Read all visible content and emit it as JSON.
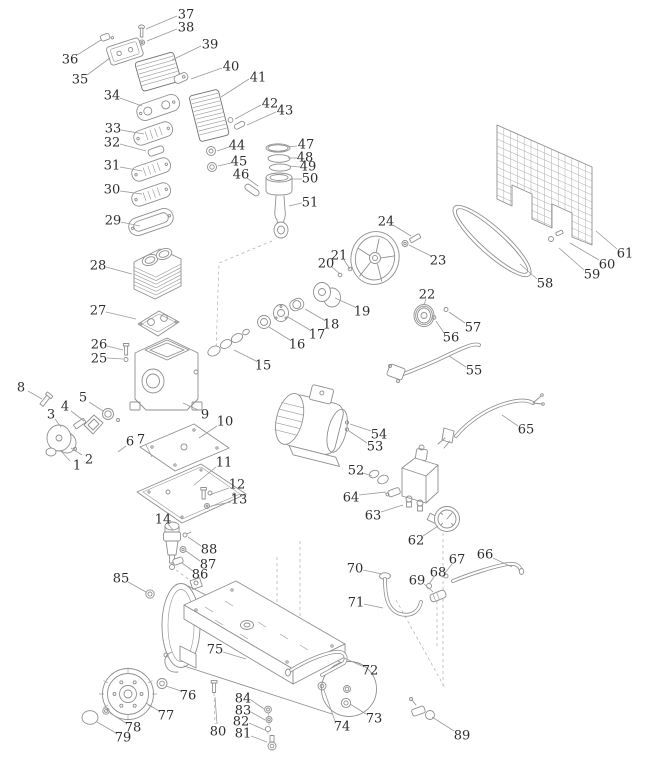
{
  "diagram": {
    "kind": "exploded-parts-diagram",
    "colors": {
      "background": "#ffffff",
      "line": "#8f8f8f",
      "line_dark": "#707070",
      "grid": "#b3b3b3",
      "label": "#2d2d2d",
      "leader": "#9a9a9a"
    },
    "callouts": [
      {
        "n": "1",
        "x": 77,
        "y": 465,
        "x1": 70,
        "y1": 461,
        "x2": 60,
        "y2": 450
      },
      {
        "n": "2",
        "x": 89,
        "y": 459,
        "x1": 82,
        "y1": 455,
        "x2": 71,
        "y2": 448
      },
      {
        "n": "3",
        "x": 51,
        "y": 414,
        "x1": 55,
        "y1": 419,
        "x2": 61,
        "y2": 427
      },
      {
        "n": "4",
        "x": 65,
        "y": 406,
        "x1": 71,
        "y1": 411,
        "x2": 84,
        "y2": 421
      },
      {
        "n": "5",
        "x": 83,
        "y": 397,
        "x1": 89,
        "y1": 402,
        "x2": 103,
        "y2": 411
      },
      {
        "n": "6",
        "x": 130,
        "y": 441,
        "x1": 126,
        "y1": 446,
        "x2": 118,
        "y2": 452
      },
      {
        "n": "7",
        "x": 141,
        "y": 439,
        "x1": 146,
        "y1": 445,
        "x2": 152,
        "y2": 457
      },
      {
        "n": "8",
        "x": 21,
        "y": 387,
        "x1": 28,
        "y1": 391,
        "x2": 42,
        "y2": 399
      },
      {
        "n": "9",
        "x": 205,
        "y": 414,
        "x1": 198,
        "y1": 410,
        "x2": 183,
        "y2": 403
      },
      {
        "n": "10",
        "x": 225,
        "y": 421,
        "x1": 217,
        "y1": 426,
        "x2": 199,
        "y2": 438
      },
      {
        "n": "11",
        "x": 224,
        "y": 462,
        "x1": 216,
        "y1": 467,
        "x2": 194,
        "y2": 485
      },
      {
        "n": "12",
        "x": 237,
        "y": 484,
        "x1": 229,
        "y1": 488,
        "x2": 209,
        "y2": 495
      },
      {
        "n": "13",
        "x": 239,
        "y": 499,
        "x1": 231,
        "y1": 502,
        "x2": 211,
        "y2": 506
      },
      {
        "n": "14",
        "x": 163,
        "y": 519,
        "x1": 168,
        "y1": 524,
        "x2": 173,
        "y2": 530
      },
      {
        "n": "15",
        "x": 263,
        "y": 365,
        "x1": 256,
        "y1": 361,
        "x2": 234,
        "y2": 350
      },
      {
        "n": "16",
        "x": 297,
        "y": 344,
        "x1": 290,
        "y1": 340,
        "x2": 269,
        "y2": 327
      },
      {
        "n": "17",
        "x": 317,
        "y": 334,
        "x1": 310,
        "y1": 330,
        "x2": 288,
        "y2": 317
      },
      {
        "n": "18",
        "x": 331,
        "y": 324,
        "x1": 324,
        "y1": 320,
        "x2": 305,
        "y2": 309
      },
      {
        "n": "19",
        "x": 362,
        "y": 311,
        "x1": 355,
        "y1": 307,
        "x2": 335,
        "y2": 298
      },
      {
        "n": "20",
        "x": 326,
        "y": 263,
        "x1": 332,
        "y1": 267,
        "x2": 340,
        "y2": 274
      },
      {
        "n": "21",
        "x": 339,
        "y": 255,
        "x1": 344,
        "y1": 260,
        "x2": 350,
        "y2": 269
      },
      {
        "n": "22",
        "x": 427,
        "y": 294,
        "x1": 426,
        "y1": 299,
        "x2": 424,
        "y2": 305
      },
      {
        "n": "23",
        "x": 438,
        "y": 260,
        "x1": 431,
        "y1": 256,
        "x2": 409,
        "y2": 245
      },
      {
        "n": "24",
        "x": 386,
        "y": 221,
        "x1": 393,
        "y1": 225,
        "x2": 411,
        "y2": 236
      },
      {
        "n": "25",
        "x": 99,
        "y": 358,
        "x1": 107,
        "y1": 358,
        "x2": 123,
        "y2": 359
      },
      {
        "n": "26",
        "x": 99,
        "y": 344,
        "x1": 107,
        "y1": 346,
        "x2": 123,
        "y2": 350
      },
      {
        "n": "27",
        "x": 98,
        "y": 310,
        "x1": 106,
        "y1": 312,
        "x2": 136,
        "y2": 319
      },
      {
        "n": "28",
        "x": 98,
        "y": 265,
        "x1": 106,
        "y1": 267,
        "x2": 132,
        "y2": 274
      },
      {
        "n": "29",
        "x": 113,
        "y": 220,
        "x1": 121,
        "y1": 222,
        "x2": 140,
        "y2": 226
      },
      {
        "n": "30",
        "x": 112,
        "y": 189,
        "x1": 120,
        "y1": 191,
        "x2": 142,
        "y2": 194
      },
      {
        "n": "31",
        "x": 112,
        "y": 165,
        "x1": 120,
        "y1": 167,
        "x2": 142,
        "y2": 171
      },
      {
        "n": "32",
        "x": 112,
        "y": 142,
        "x1": 120,
        "y1": 144,
        "x2": 146,
        "y2": 151
      },
      {
        "n": "33",
        "x": 113,
        "y": 128,
        "x1": 121,
        "y1": 130,
        "x2": 144,
        "y2": 134
      },
      {
        "n": "34",
        "x": 112,
        "y": 95,
        "x1": 120,
        "y1": 98,
        "x2": 142,
        "y2": 106
      },
      {
        "n": "35",
        "x": 80,
        "y": 79,
        "x1": 87,
        "y1": 75,
        "x2": 110,
        "y2": 58
      },
      {
        "n": "36",
        "x": 70,
        "y": 59,
        "x1": 77,
        "y1": 55,
        "x2": 101,
        "y2": 40
      },
      {
        "n": "37",
        "x": 186,
        "y": 14,
        "x1": 177,
        "y1": 16,
        "x2": 146,
        "y2": 29
      },
      {
        "n": "38",
        "x": 186,
        "y": 27,
        "x1": 177,
        "y1": 29,
        "x2": 147,
        "y2": 41
      },
      {
        "n": "39",
        "x": 210,
        "y": 44,
        "x1": 201,
        "y1": 46,
        "x2": 172,
        "y2": 60
      },
      {
        "n": "40",
        "x": 231,
        "y": 66,
        "x1": 222,
        "y1": 68,
        "x2": 191,
        "y2": 79
      },
      {
        "n": "41",
        "x": 258,
        "y": 77,
        "x1": 249,
        "y1": 79,
        "x2": 221,
        "y2": 97
      },
      {
        "n": "42",
        "x": 270,
        "y": 103,
        "x1": 261,
        "y1": 105,
        "x2": 235,
        "y2": 119
      },
      {
        "n": "43",
        "x": 285,
        "y": 110,
        "x1": 276,
        "y1": 112,
        "x2": 247,
        "y2": 125
      },
      {
        "n": "44",
        "x": 237,
        "y": 145,
        "x1": 229,
        "y1": 147,
        "x2": 217,
        "y2": 151
      },
      {
        "n": "45",
        "x": 239,
        "y": 161,
        "x1": 231,
        "y1": 163,
        "x2": 218,
        "y2": 166
      },
      {
        "n": "46",
        "x": 241,
        "y": 174,
        "x1": 247,
        "y1": 178,
        "x2": 258,
        "y2": 186
      },
      {
        "n": "47",
        "x": 306,
        "y": 144,
        "x1": 297,
        "y1": 146,
        "x2": 287,
        "y2": 147
      },
      {
        "n": "48",
        "x": 305,
        "y": 157,
        "x1": 297,
        "y1": 158,
        "x2": 288,
        "y2": 158
      },
      {
        "n": "49",
        "x": 308,
        "y": 166,
        "x1": 300,
        "y1": 167,
        "x2": 289,
        "y2": 166
      },
      {
        "n": "50",
        "x": 310,
        "y": 178,
        "x1": 302,
        "y1": 179,
        "x2": 290,
        "y2": 179
      },
      {
        "n": "51",
        "x": 310,
        "y": 202,
        "x1": 302,
        "y1": 203,
        "x2": 289,
        "y2": 206
      },
      {
        "n": "52",
        "x": 356,
        "y": 470,
        "x1": 363,
        "y1": 473,
        "x2": 372,
        "y2": 476
      },
      {
        "n": "53",
        "x": 375,
        "y": 446,
        "x1": 367,
        "y1": 443,
        "x2": 349,
        "y2": 431
      },
      {
        "n": "54",
        "x": 379,
        "y": 434,
        "x1": 371,
        "y1": 431,
        "x2": 350,
        "y2": 424
      },
      {
        "n": "55",
        "x": 474,
        "y": 370,
        "x1": 466,
        "y1": 367,
        "x2": 449,
        "y2": 356
      },
      {
        "n": "56",
        "x": 451,
        "y": 337,
        "x1": 444,
        "y1": 333,
        "x2": 436,
        "y2": 321
      },
      {
        "n": "57",
        "x": 473,
        "y": 327,
        "x1": 465,
        "y1": 323,
        "x2": 449,
        "y2": 312
      },
      {
        "n": "58",
        "x": 545,
        "y": 283,
        "x1": 537,
        "y1": 279,
        "x2": 520,
        "y2": 264
      },
      {
        "n": "59",
        "x": 592,
        "y": 274,
        "x1": 584,
        "y1": 270,
        "x2": 559,
        "y2": 248
      },
      {
        "n": "60",
        "x": 607,
        "y": 264,
        "x1": 599,
        "y1": 260,
        "x2": 570,
        "y2": 243
      },
      {
        "n": "61",
        "x": 625,
        "y": 253,
        "x1": 617,
        "y1": 249,
        "x2": 596,
        "y2": 231
      },
      {
        "n": "62",
        "x": 416,
        "y": 540,
        "x1": 423,
        "y1": 536,
        "x2": 438,
        "y2": 526
      },
      {
        "n": "63",
        "x": 373,
        "y": 515,
        "x1": 381,
        "y1": 512,
        "x2": 403,
        "y2": 505
      },
      {
        "n": "64",
        "x": 351,
        "y": 497,
        "x1": 359,
        "y1": 495,
        "x2": 386,
        "y2": 492
      },
      {
        "n": "65",
        "x": 526,
        "y": 429,
        "x1": 518,
        "y1": 426,
        "x2": 502,
        "y2": 415
      },
      {
        "n": "66",
        "x": 485,
        "y": 554,
        "x1": 493,
        "y1": 558,
        "x2": 512,
        "y2": 567
      },
      {
        "n": "67",
        "x": 457,
        "y": 559,
        "x1": 452,
        "y1": 564,
        "x2": 445,
        "y2": 573
      },
      {
        "n": "68",
        "x": 438,
        "y": 572,
        "x1": 434,
        "y1": 577,
        "x2": 429,
        "y2": 584
      },
      {
        "n": "69",
        "x": 417,
        "y": 580,
        "x1": 424,
        "y1": 584,
        "x2": 433,
        "y2": 592
      },
      {
        "n": "70",
        "x": 355,
        "y": 568,
        "x1": 363,
        "y1": 570,
        "x2": 382,
        "y2": 574
      },
      {
        "n": "71",
        "x": 356,
        "y": 602,
        "x1": 364,
        "y1": 604,
        "x2": 383,
        "y2": 608
      },
      {
        "n": "72",
        "x": 370,
        "y": 670,
        "x1": 362,
        "y1": 666,
        "x2": 344,
        "y2": 658
      },
      {
        "n": "73",
        "x": 374,
        "y": 718,
        "x1": 366,
        "y1": 714,
        "x2": 350,
        "y2": 704
      },
      {
        "n": "74",
        "x": 342,
        "y": 726,
        "x1": 335,
        "y1": 721,
        "x2": 324,
        "y2": 690
      },
      {
        "n": "75",
        "x": 215,
        "y": 649,
        "x1": 223,
        "y1": 652,
        "x2": 246,
        "y2": 659
      },
      {
        "n": "76",
        "x": 188,
        "y": 695,
        "x1": 181,
        "y1": 691,
        "x2": 166,
        "y2": 686
      },
      {
        "n": "77",
        "x": 166,
        "y": 715,
        "x1": 159,
        "y1": 711,
        "x2": 146,
        "y2": 703
      },
      {
        "n": "78",
        "x": 133,
        "y": 727,
        "x1": 126,
        "y1": 723,
        "x2": 110,
        "y2": 713
      },
      {
        "n": "79",
        "x": 123,
        "y": 737,
        "x1": 116,
        "y1": 733,
        "x2": 97,
        "y2": 722
      },
      {
        "n": "80",
        "x": 218,
        "y": 731,
        "x1": 217,
        "y1": 724,
        "x2": 215,
        "y2": 697
      },
      {
        "n": "81",
        "x": 243,
        "y": 733,
        "x1": 251,
        "y1": 736,
        "x2": 267,
        "y2": 742
      },
      {
        "n": "82",
        "x": 241,
        "y": 721,
        "x1": 249,
        "y1": 723,
        "x2": 265,
        "y2": 730
      },
      {
        "n": "83",
        "x": 243,
        "y": 710,
        "x1": 251,
        "y1": 712,
        "x2": 265,
        "y2": 720
      },
      {
        "n": "84",
        "x": 243,
        "y": 698,
        "x1": 251,
        "y1": 700,
        "x2": 264,
        "y2": 709
      },
      {
        "n": "85",
        "x": 121,
        "y": 578,
        "x1": 128,
        "y1": 582,
        "x2": 146,
        "y2": 592
      },
      {
        "n": "86",
        "x": 200,
        "y": 574,
        "x1": 193,
        "y1": 571,
        "x2": 182,
        "y2": 563
      },
      {
        "n": "87",
        "x": 208,
        "y": 564,
        "x1": 200,
        "y1": 561,
        "x2": 186,
        "y2": 551
      },
      {
        "n": "88",
        "x": 209,
        "y": 549,
        "x1": 201,
        "y1": 546,
        "x2": 188,
        "y2": 537
      },
      {
        "n": "89",
        "x": 462,
        "y": 735,
        "x1": 454,
        "y1": 731,
        "x2": 432,
        "y2": 717
      }
    ]
  }
}
